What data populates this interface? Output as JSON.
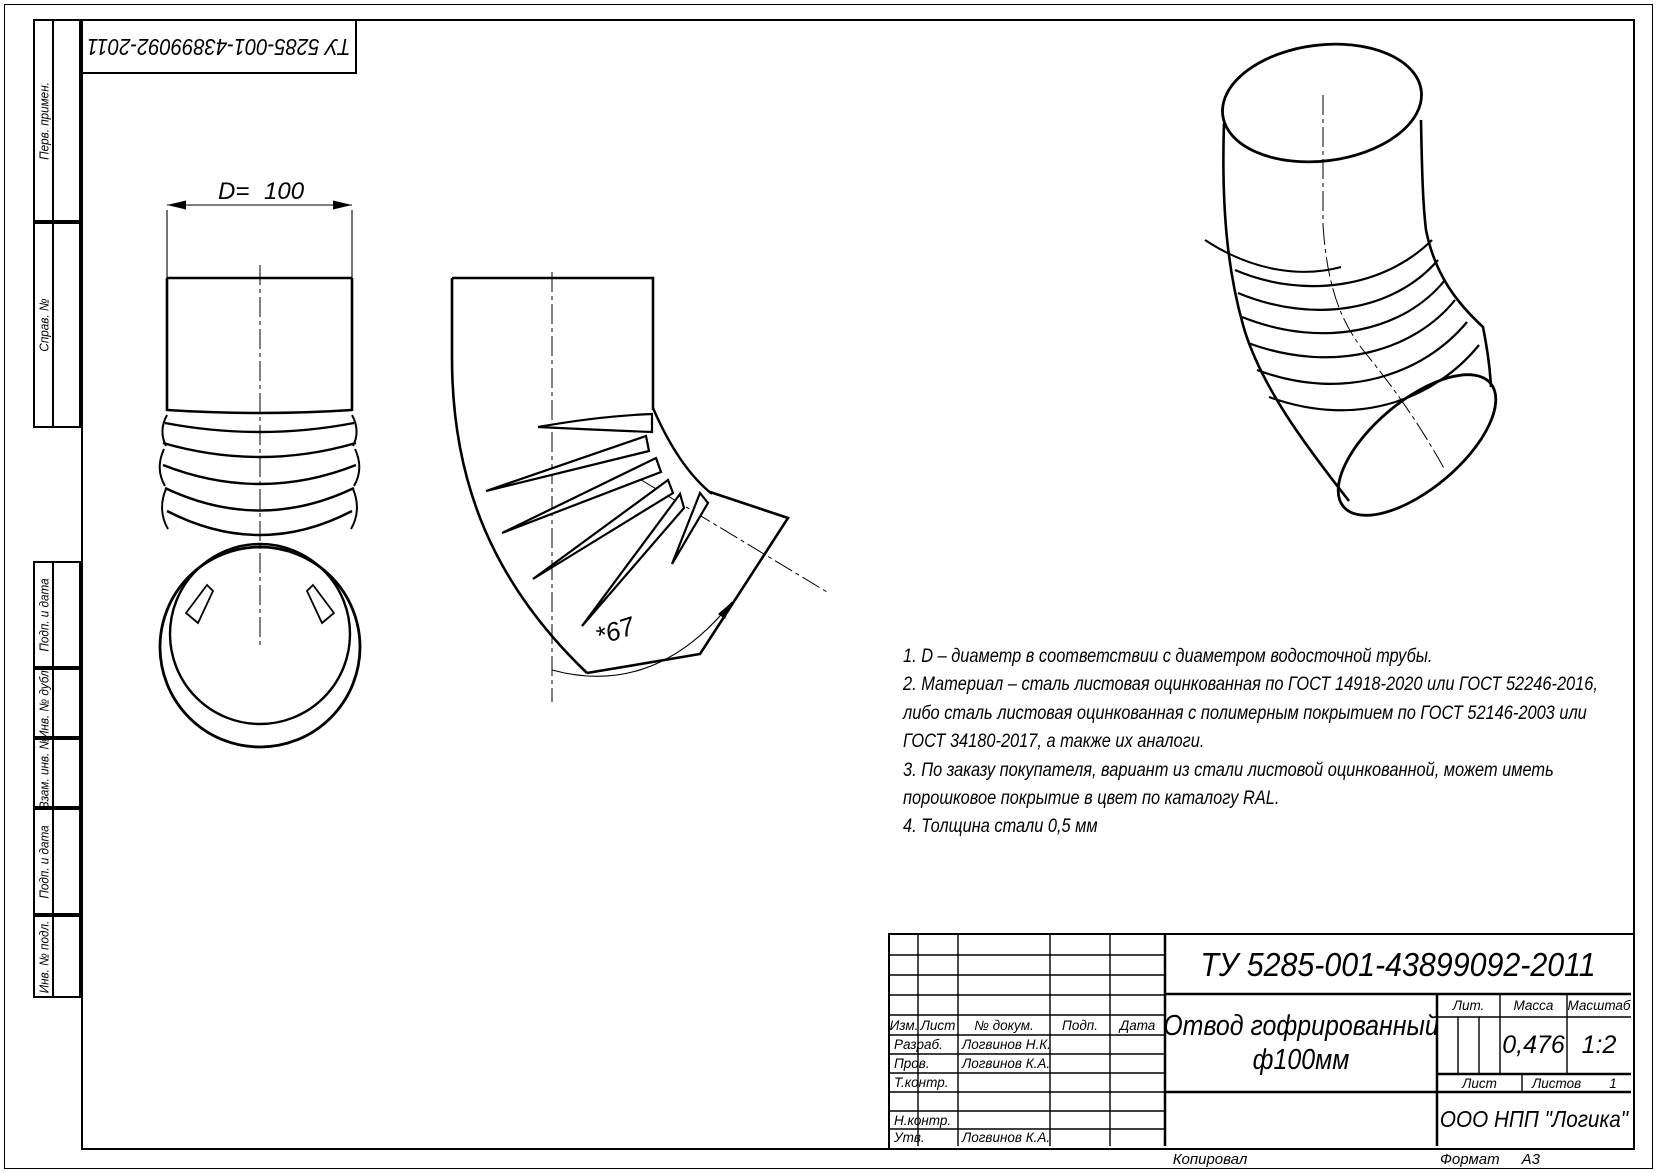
{
  "page": {
    "copied_label": "Копировал",
    "format_label": "Формат",
    "format_value": "А3"
  },
  "tu_stamp": {
    "text": "ТУ 5285-001-43899092-2011"
  },
  "sidebar": {
    "items": [
      "Перв. примен.",
      "Справ. №",
      "Подп. и дата",
      "Инв. № дубл.",
      "Взам. инв. №",
      "Подп. и дата",
      "Инв. № подл."
    ]
  },
  "views": {
    "front": {
      "dim_label": "D=",
      "dim_value": "100"
    },
    "side": {
      "angle_label": "*67"
    }
  },
  "notes": {
    "lines": [
      "1. D – диаметр в соответствии с диаметром водосточной трубы.",
      "2. Материал – сталь листовая оцинкованная по ГОСТ 14918-2020 или ГОСТ 52246-2016,",
      "либо сталь листовая оцинкованная с полимерным покрытием по ГОСТ 52146-2003 или",
      "ГОСТ 34180-2017, а также их аналоги.",
      "3. По заказу покупателя, вариант из стали листовой оцинкованной, может иметь",
      "порошковое покрытие в цвет по каталогу RAL.",
      "4. Толщина стали 0,5 мм"
    ]
  },
  "titleblock": {
    "doc_number": "ТУ 5285-001-43899092-2011",
    "header": {
      "izm": "Изм.",
      "list": "Лист",
      "doc": "№ докум.",
      "podp": "Подп.",
      "data": "Дата"
    },
    "rows": [
      {
        "label": "Разраб.",
        "name": "Логвинов Н.К."
      },
      {
        "label": "Пров.",
        "name": "Логвинов К.А."
      },
      {
        "label": "Т.контр.",
        "name": ""
      },
      {
        "label": "Н.контр.",
        "name": ""
      },
      {
        "label": "Утв.",
        "name": "Логвинов К.А."
      }
    ],
    "product_title_line1": "Отвод гофрированный",
    "product_title_line2": "ф100мм",
    "lit_label": "Лит.",
    "mass_label": "Масса",
    "scale_label": "Масштаб",
    "mass_value": "0,476",
    "scale_value": "1:2",
    "sheet_label": "Лист",
    "sheets_label": "Листов",
    "sheets_value": "1",
    "company": "ООО НПП \"Логика\""
  }
}
